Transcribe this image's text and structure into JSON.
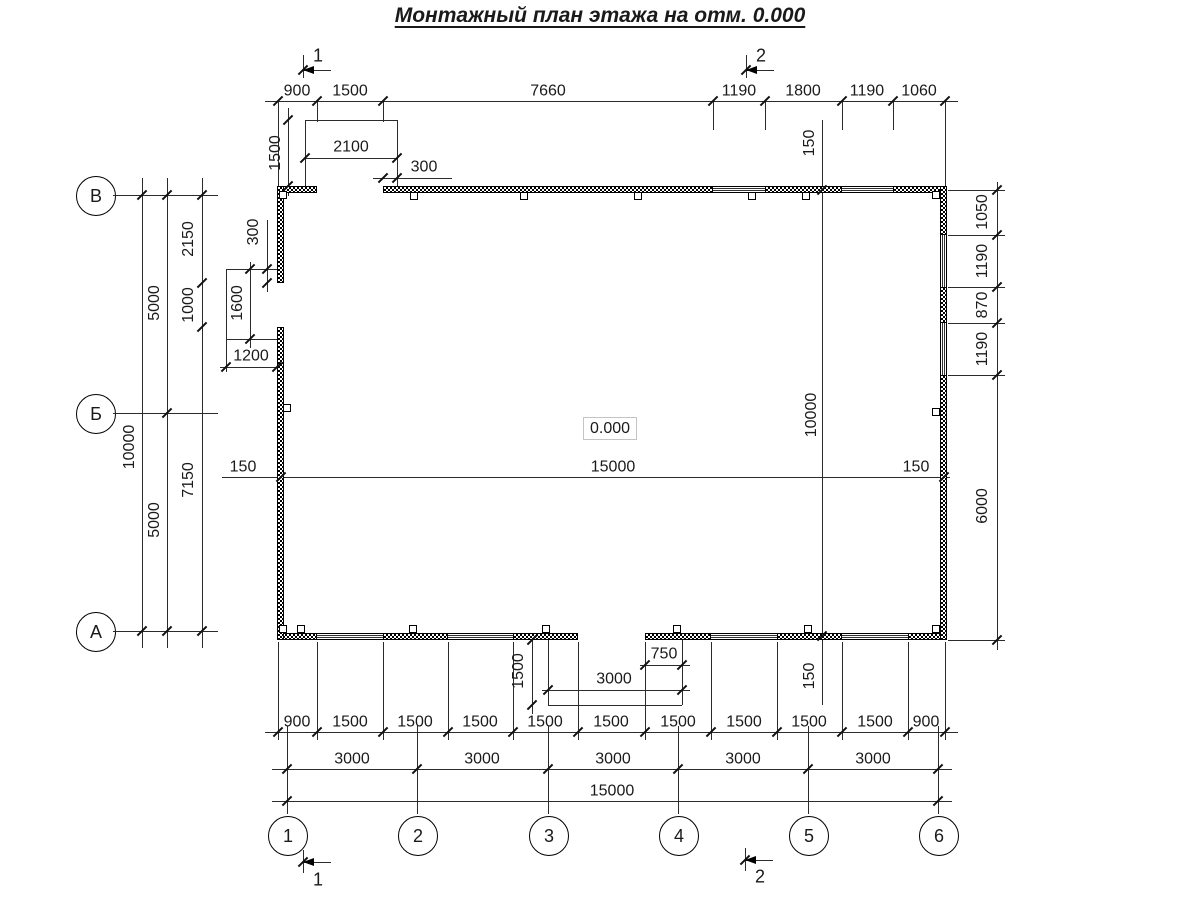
{
  "title": "Монтажный план этажа на отм. 0.000",
  "elevation": "0.000",
  "axes": {
    "rows": [
      "В",
      "Б",
      "А"
    ],
    "cols": [
      "1",
      "2",
      "3",
      "4",
      "5",
      "6"
    ]
  },
  "section_marks": {
    "top_1": "1",
    "top_2": "2",
    "bottom_1": "1",
    "bottom_2": "2"
  },
  "dims": {
    "top_row": [
      "900",
      "1500",
      "7660",
      "1190",
      "1800",
      "1190",
      "1060"
    ],
    "top_door": {
      "depth": "1500",
      "width": "2100",
      "offset": "300"
    },
    "left_outer": [
      "10000"
    ],
    "left_mid": [
      "5000",
      "5000"
    ],
    "left_inner": [
      "2150",
      "1000",
      "7150"
    ],
    "left_door": {
      "height": "1600",
      "depth": "1200",
      "offset": "300"
    },
    "interior_width": [
      "150",
      "15000",
      "150"
    ],
    "interior_height": [
      "150",
      "10000",
      "150"
    ],
    "right_col": [
      "1050",
      "1190",
      "870",
      "1190",
      "6000"
    ],
    "bottom_porch": {
      "depth": "1500",
      "offset": "750",
      "width": "3000"
    },
    "bottom_row1": [
      "900",
      "1500",
      "1500",
      "1500",
      "1500",
      "1500",
      "1500",
      "1500",
      "1500",
      "1500",
      "900"
    ],
    "bottom_row2": [
      "3000",
      "3000",
      "3000",
      "3000",
      "3000"
    ],
    "bottom_row3": [
      "15000"
    ]
  }
}
